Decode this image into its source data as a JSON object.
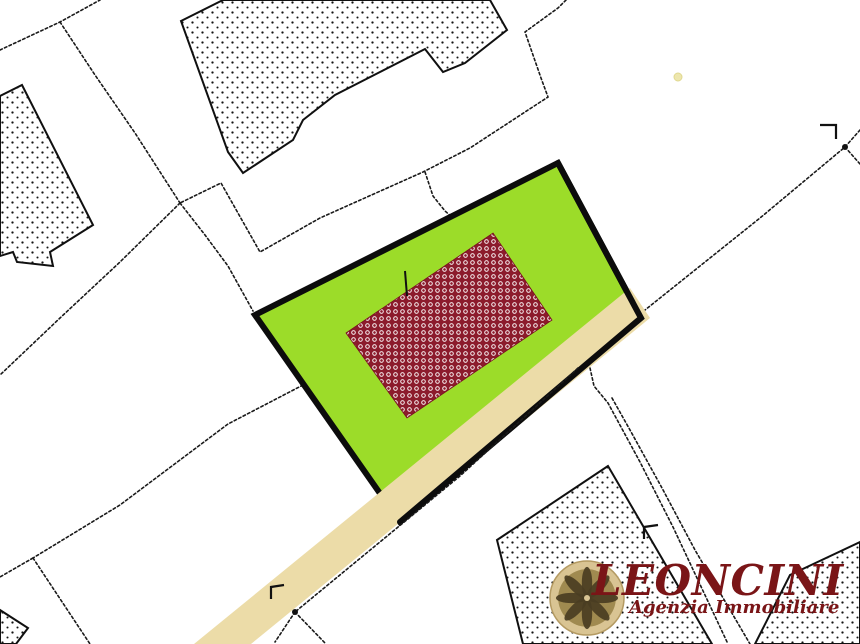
{
  "logo": {
    "title": "LEONCINI",
    "subtitle": "Agenzia Immobiliare",
    "title_color": "#7A1517"
  },
  "colors": {
    "background": "#FFFFFF",
    "parcel_green": "#9CDC29",
    "parcel_border": "#0C0C0C",
    "road_beige": "#ECDCA8",
    "building_dot": "#141414",
    "building_outline": "#101010",
    "boundary_line": "#1A1A1A",
    "red_building_fill": "#8C1B2C",
    "red_building_ring": "#FFFFFF",
    "yellow_dot": "#EDE6AD",
    "rosette_outer": "#D9C493",
    "rosette_face": "#A08A50",
    "rosette_petal": "#4A3D22"
  },
  "map": {
    "buildings": [
      {
        "name": "hatched-building-left",
        "points": [
          [
            0,
            96
          ],
          [
            22,
            85
          ],
          [
            93,
            225
          ],
          [
            50,
            252
          ],
          [
            53,
            266
          ],
          [
            17,
            262
          ],
          [
            13,
            252
          ],
          [
            0,
            256
          ]
        ]
      },
      {
        "name": "hatched-building-top",
        "points": [
          [
            181,
            21
          ],
          [
            223,
            0
          ],
          [
            490,
            0
          ],
          [
            507,
            30
          ],
          [
            465,
            63
          ],
          [
            443,
            72
          ],
          [
            425,
            49
          ],
          [
            380,
            72
          ],
          [
            335,
            95
          ],
          [
            303,
            120
          ],
          [
            293,
            140
          ],
          [
            243,
            173
          ],
          [
            228,
            152
          ]
        ]
      },
      {
        "name": "hatched-building-bottom-right",
        "points": [
          [
            608,
            466
          ],
          [
            497,
            540
          ],
          [
            523,
            644
          ],
          [
            712,
            644
          ]
        ]
      },
      {
        "name": "hatched-building-bottom-left-corner",
        "points": [
          [
            0,
            610
          ],
          [
            28,
            628
          ],
          [
            16,
            644
          ],
          [
            0,
            644
          ]
        ]
      },
      {
        "name": "hatched-building-corner-right",
        "points": [
          [
            860,
            542
          ],
          [
            790,
            575
          ],
          [
            755,
            644
          ],
          [
            860,
            644
          ]
        ]
      }
    ],
    "boundary_lines": [
      {
        "name": "parcel-line-topleft-a",
        "points": [
          [
            0,
            50
          ],
          [
            60,
            22
          ],
          [
            100,
            0
          ]
        ]
      },
      {
        "name": "parcel-line-topleft-b",
        "points": [
          [
            60,
            22
          ],
          [
            95,
            75
          ],
          [
            135,
            133
          ],
          [
            180,
            203
          ]
        ]
      },
      {
        "name": "parcel-line-left-diagonal",
        "points": [
          [
            180,
            203
          ],
          [
            120,
            262
          ],
          [
            60,
            318
          ],
          [
            0,
            375
          ]
        ]
      },
      {
        "name": "parcel-line-to-green-corner",
        "points": [
          [
            180,
            203
          ],
          [
            205,
            235
          ],
          [
            228,
            266
          ],
          [
            253,
            311
          ]
        ]
      },
      {
        "name": "parcel-line-central-zigzag",
        "points": [
          [
            566,
            0
          ],
          [
            558,
            8
          ],
          [
            525,
            32
          ],
          [
            541,
            78
          ],
          [
            548,
            97
          ],
          [
            470,
            148
          ],
          [
            423,
            172
          ],
          [
            320,
            218
          ],
          [
            260,
            252
          ],
          [
            221,
            183
          ],
          [
            180,
            203
          ]
        ]
      },
      {
        "name": "parcel-line-branch-to-green",
        "points": [
          [
            425,
            172
          ],
          [
            433,
            196
          ],
          [
            445,
            211
          ],
          [
            452,
            217
          ]
        ]
      },
      {
        "name": "parcel-line-topright-diagonal",
        "points": [
          [
            860,
            130
          ],
          [
            845,
            147
          ],
          [
            760,
            218
          ],
          [
            680,
            282
          ],
          [
            645,
            310
          ]
        ]
      },
      {
        "name": "parcel-line-topright-stub",
        "points": [
          [
            845,
            147
          ],
          [
            860,
            164
          ]
        ]
      },
      {
        "name": "parcel-line-lower-left",
        "points": [
          [
            303,
            385
          ],
          [
            228,
            424
          ],
          [
            120,
            505
          ],
          [
            33,
            558
          ]
        ]
      },
      {
        "name": "parcel-line-lower-left-south",
        "points": [
          [
            33,
            558
          ],
          [
            90,
            644
          ]
        ]
      },
      {
        "name": "parcel-line-lower-left-west",
        "points": [
          [
            33,
            558
          ],
          [
            0,
            577
          ]
        ]
      },
      {
        "name": "parcel-line-corridor-left",
        "points": [
          [
            590,
            368
          ],
          [
            594,
            386
          ],
          [
            608,
            403
          ],
          [
            640,
            462
          ],
          [
            673,
            527
          ],
          [
            728,
            644
          ]
        ]
      },
      {
        "name": "parcel-line-corridor-right",
        "points": [
          [
            612,
            398
          ],
          [
            630,
            430
          ],
          [
            662,
            488
          ],
          [
            695,
            550
          ],
          [
            750,
            644
          ]
        ]
      }
    ],
    "highlighted_parcel": {
      "name": "highlighted-parcel",
      "points": [
        [
          255,
          315
        ],
        [
          558,
          163
        ],
        [
          641,
          318
        ],
        [
          400,
          522
        ]
      ]
    },
    "road": {
      "name": "road-strip",
      "points": [
        [
          630,
          288
        ],
        [
          650,
          318
        ],
        [
          251,
          644
        ],
        [
          194,
          644
        ]
      ]
    },
    "parcel_border_road_edge": {
      "name": "parcel-border-road-edge",
      "points": [
        [
          558,
          163
        ],
        [
          641,
          318
        ],
        [
          400,
          522
        ]
      ]
    },
    "road_dashed_lines": [
      {
        "name": "road-hidden-boundary",
        "points": [
          [
            578,
            368
          ],
          [
            460,
            476
          ],
          [
            295,
            612
          ]
        ]
      },
      {
        "name": "road-hidden-boundary-branch-left",
        "points": [
          [
            295,
            612
          ],
          [
            275,
            642
          ]
        ]
      },
      {
        "name": "road-hidden-boundary-branch-right",
        "points": [
          [
            295,
            612
          ],
          [
            325,
            643
          ]
        ]
      }
    ],
    "red_building": {
      "name": "subject-building",
      "points": [
        [
          493,
          233
        ],
        [
          552,
          320
        ],
        [
          407,
          418
        ],
        [
          346,
          333
        ]
      ],
      "tick": [
        [
          405,
          271
        ],
        [
          407,
          296
        ]
      ]
    },
    "corner_marks": [
      {
        "name": "corner-mark-top-right",
        "points": [
          [
            820,
            125
          ],
          [
            836,
            125
          ],
          [
            836,
            139
          ]
        ]
      },
      {
        "name": "corner-mark-mid-right",
        "points": [
          [
            644,
            539
          ],
          [
            644,
            527
          ],
          [
            658,
            525
          ]
        ]
      },
      {
        "name": "corner-mark-road",
        "points": [
          [
            271,
            599
          ],
          [
            271,
            587
          ],
          [
            284,
            585
          ]
        ]
      }
    ],
    "junction_dots": [
      {
        "name": "junction-dot-topright",
        "cx": 845,
        "cy": 147,
        "r": 3
      },
      {
        "name": "junction-dot-road",
        "cx": 295,
        "cy": 612,
        "r": 3
      }
    ],
    "yellow_dot": {
      "name": "small-yellow-dot",
      "cx": 678,
      "cy": 77,
      "r": 4
    },
    "rosette": {
      "name": "logo-rosette",
      "cx": 587,
      "cy": 598,
      "r": 37
    }
  }
}
